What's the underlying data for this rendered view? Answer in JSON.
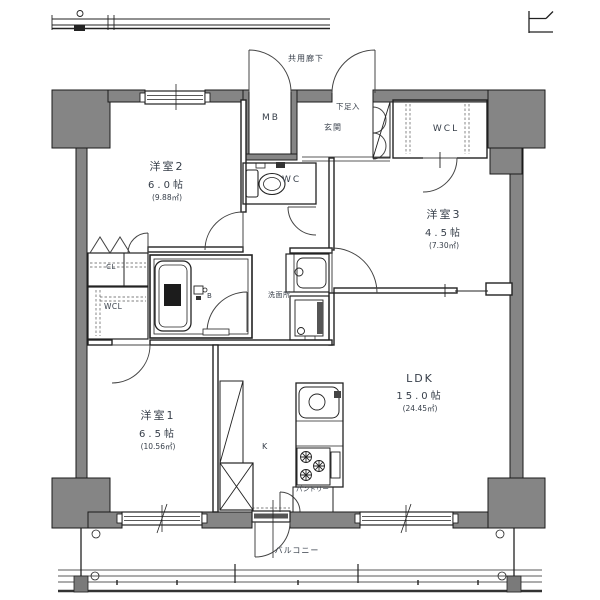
{
  "plan_type": "apartment-floor-plan",
  "rooms": {
    "western2": {
      "name": "洋室2",
      "size": "6.0帖",
      "area": "(9.88㎡)"
    },
    "western3": {
      "name": "洋室3",
      "size": "4.5帖",
      "area": "(7.30㎡)"
    },
    "western1": {
      "name": "洋室1",
      "size": "6.5帖",
      "area": "(10.56㎡)"
    },
    "ldk": {
      "name": "LDK",
      "size": "15.0帖",
      "area": "(24.45㎡)"
    }
  },
  "labels": {
    "common_corridor": "共用廊下",
    "meter_box": "MB",
    "shoe_cabinet": "下足入",
    "entrance": "玄関",
    "walkin_closet_right": "WCL",
    "toilet": "WC",
    "closet": "CL",
    "walkin_closet_left": "WCL",
    "bath": "B",
    "washroom": "洗面所",
    "kitchen": "K",
    "pantry": "パントリー",
    "balcony": "バルコニー"
  },
  "colors": {
    "wall_fill": "#858585",
    "line": "#1a1a1a",
    "label_text": "#363e49",
    "background": "#ffffff"
  }
}
